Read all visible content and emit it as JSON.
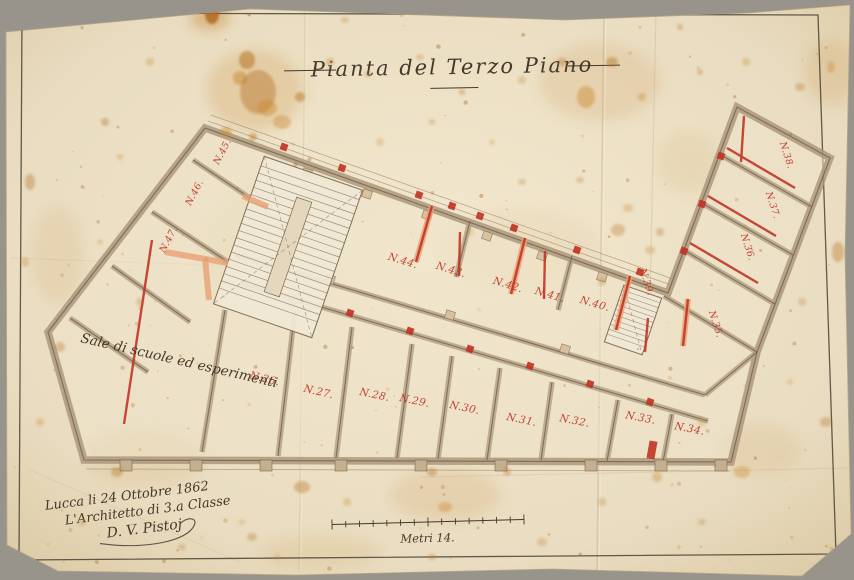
{
  "sheet": {
    "title": "Pianta del Terzo Piano",
    "room_use_note": "Sale di scuole ed esperimenti",
    "scale_label": "Metri 14.",
    "signature_block": {
      "place_date": "Lucca li 24 Ottobre 1862",
      "role": "L'Architetto di 3.a Classe",
      "signature": "D. V. Pistoj"
    },
    "rooms": {
      "n26": "N.26.",
      "n27": "N.27.",
      "n28": "N.28.",
      "n29": "N.29.",
      "n30": "N.30.",
      "n31": "N.31.",
      "n32": "N.32.",
      "n33": "N.33.",
      "n34": "N.34.",
      "n35": "N.35.",
      "n36": "N.36.",
      "n37": "N.37.",
      "n38": "N.38.",
      "n39": "N.39.",
      "n40": "N.40.",
      "n41": "N.41.",
      "n42": "N.42.",
      "n43": "N.43.",
      "n44": "N.44.",
      "n45": "N.45.",
      "n46": "N.46.",
      "n47": "N.47."
    },
    "colors": {
      "paper": "#e9dcc0",
      "backdrop": "#98938b",
      "ink": "#44392b",
      "wall_wash": "#b5a185",
      "accent_red": "#c13526",
      "accent_salmon": "#e9a074",
      "stain_rust": "#b26a1c"
    }
  }
}
